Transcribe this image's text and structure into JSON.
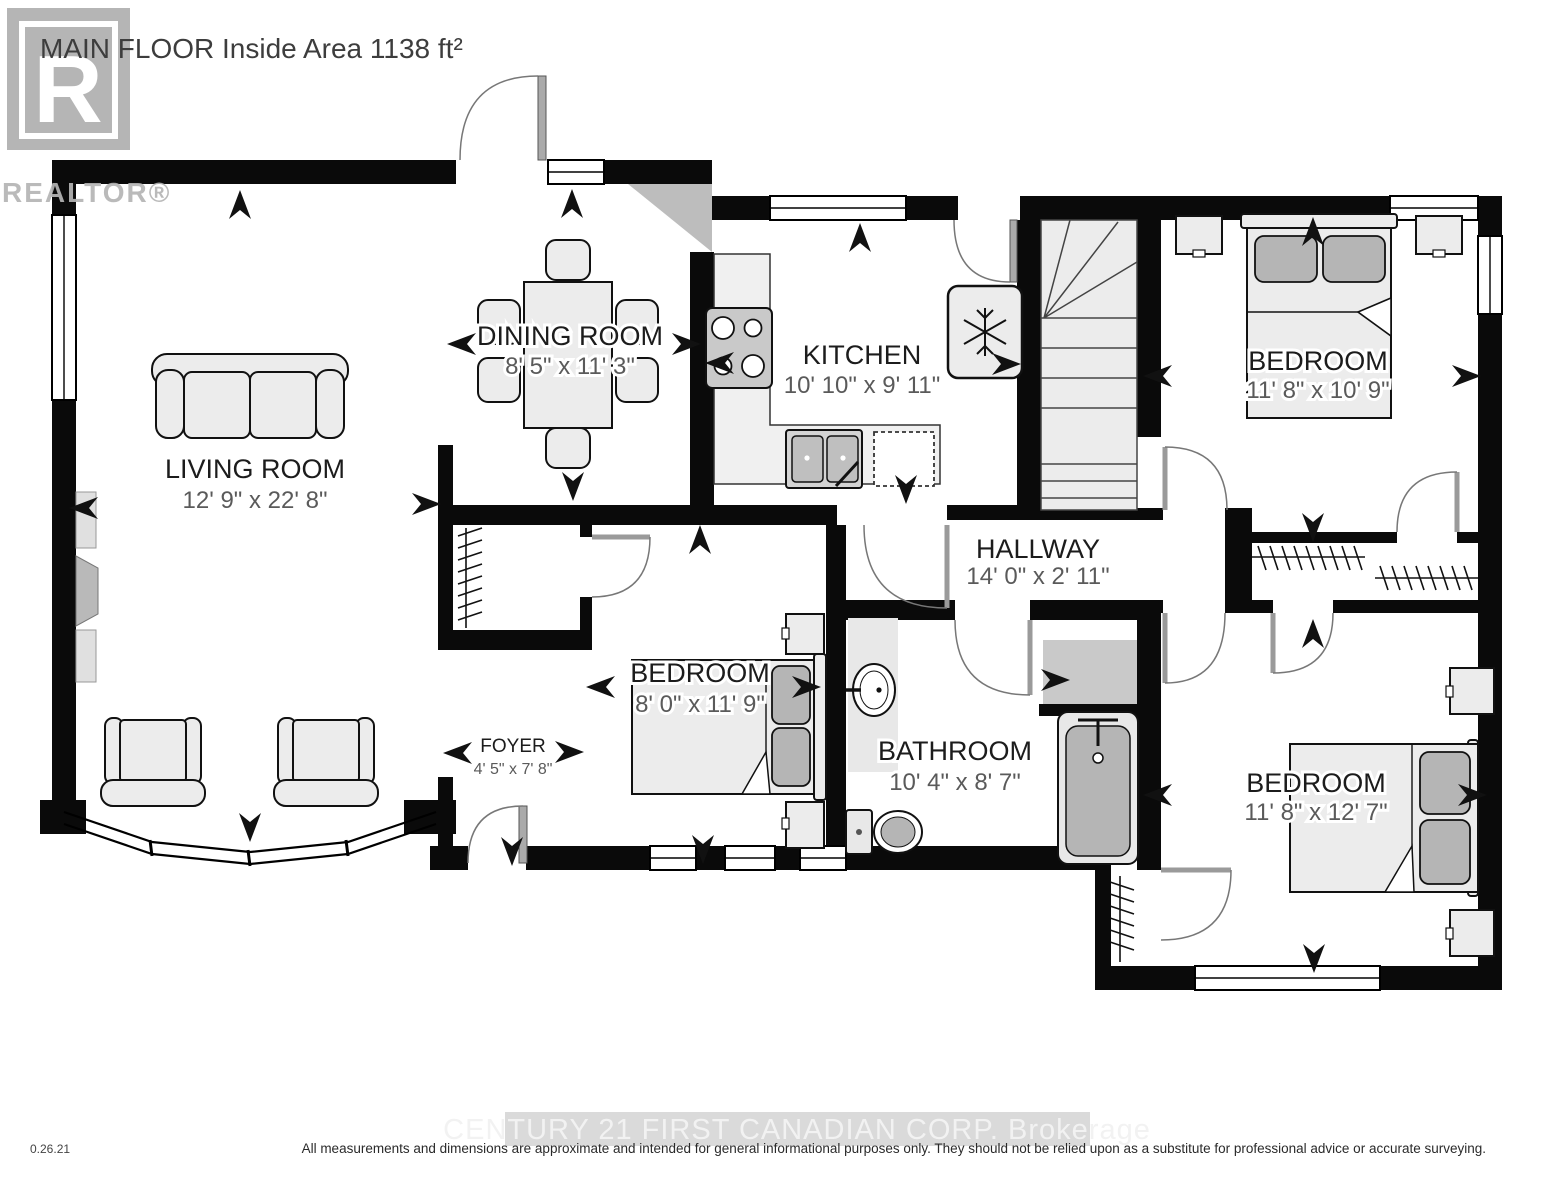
{
  "header": {
    "title": "MAIN FLOOR Inside Area 1138 ft²",
    "logo_letter": "R",
    "logo_text": "REALTOR®"
  },
  "rooms": [
    {
      "id": "living-room",
      "name": "LIVING ROOM",
      "dims": "12' 9\" x 22' 8\""
    },
    {
      "id": "dining-room",
      "name": "DINING ROOM",
      "dims": "8' 5\" x 11' 3\""
    },
    {
      "id": "kitchen",
      "name": "KITCHEN",
      "dims": "10' 10\" x 9' 11\""
    },
    {
      "id": "hallway",
      "name": "HALLWAY",
      "dims": "14' 0\" x 2' 11\""
    },
    {
      "id": "foyer",
      "name": "FOYER",
      "dims": "4' 5\" x 7' 8\""
    },
    {
      "id": "bedroom-top",
      "name": "BEDROOM",
      "dims": "11' 8\" x 10' 9\""
    },
    {
      "id": "bedroom-mid",
      "name": "BEDROOM",
      "dims": "8' 0\" x 11' 9\""
    },
    {
      "id": "bathroom",
      "name": "BATHROOM",
      "dims": "10' 4\" x 8' 7\""
    },
    {
      "id": "bedroom-bottom",
      "name": "BEDROOM",
      "dims": "11' 8\" x 12' 7\""
    }
  ],
  "fixtures": [
    "sofa",
    "armchair",
    "dining-table",
    "dining-chair",
    "stove",
    "kitchen-sink",
    "dishwasher",
    "fridge",
    "stairs",
    "bed",
    "nightstand",
    "bathtub",
    "toilet",
    "vanity-sink",
    "closet-rod",
    "fireplace",
    "bay-window"
  ],
  "footer": {
    "version": "0.26.21",
    "watermark": "CENTURY 21 FIRST CANADIAN CORP. Brokerage",
    "disclaimer": "All measurements and dimensions are approximate and intended for general informational purposes only. They should not be relied upon as a substitute for professional advice or accurate surveying."
  },
  "colors": {
    "wall": "#0a0a0a",
    "furniture": "#ececec",
    "pillow": "#b5b5b5",
    "logo_gray": "#b5b5b5",
    "watermark_bg": "#dadada",
    "watermark_text": "#f2f2f2"
  }
}
